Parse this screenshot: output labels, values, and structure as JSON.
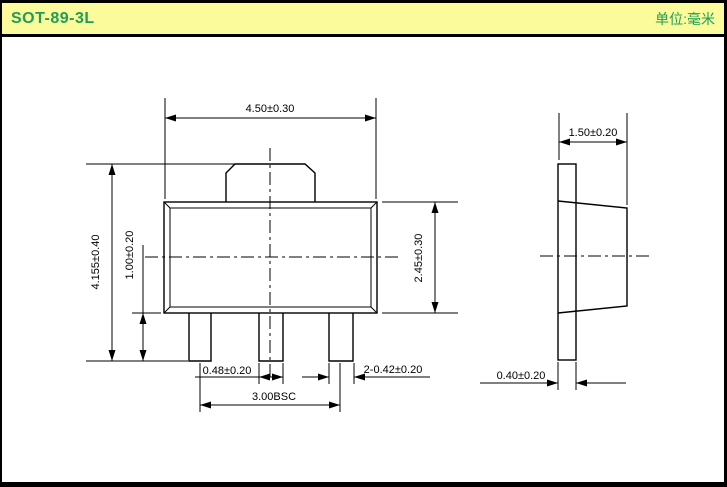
{
  "header": {
    "title": "SOT-89-3L",
    "unit": "单位:毫米"
  },
  "colors": {
    "header_bg": "#fbfb9b",
    "header_text": "#1f9d57",
    "line_color": "#000000",
    "background": "#ffffff"
  },
  "drawing": {
    "front_view": {
      "top_width": "4.50±0.30",
      "overall_height": "4.155±0.40",
      "lead_length": "1.00±0.20",
      "body_height": "2.45±0.30",
      "center_lead_width": "0.48±0.20",
      "outer_lead_width": "2-0.42±0.20",
      "lead_pitch": "3.00BSC"
    },
    "side_view": {
      "body_width": "1.50±0.20",
      "lead_thickness": "0.40±0.20"
    }
  }
}
